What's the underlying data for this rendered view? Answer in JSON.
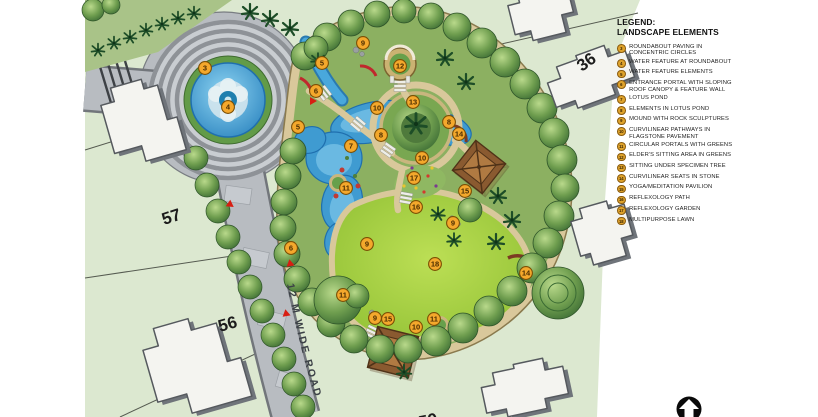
{
  "legend": {
    "title_line1": "LEGEND:",
    "title_line2": "LANDSCAPE ELEMENTS",
    "items": [
      {
        "num": "3",
        "label": "ROUNDABOUT PAVING IN CONCENTRIC CIRCLES"
      },
      {
        "num": "4",
        "label": "WATER FEATURE AT ROUNDABOUT"
      },
      {
        "num": "5",
        "label": "WATER FEATURE ELEMENTS"
      },
      {
        "num": "6",
        "label": "ENTRANCE PORTAL WITH SLOPING ROOF CANOPY & FEATURE WALL"
      },
      {
        "num": "7",
        "label": "LOTUS POND"
      },
      {
        "num": "8",
        "label": "ELEMENTS IN LOTUS POND"
      },
      {
        "num": "9",
        "label": "MOUND WITH ROCK SCULPTURES"
      },
      {
        "num": "10",
        "label": "CURVILINEAR PATHWAYS IN FLAGSTONE PAVEMENT"
      },
      {
        "num": "11",
        "label": "CIRCULAR PORTALS WITH GREENS"
      },
      {
        "num": "12",
        "label": "ELDER'S SITTING AREA IN GREENS"
      },
      {
        "num": "13",
        "label": "SITTING UNDER SPECIMEN TREE"
      },
      {
        "num": "14",
        "label": "CURVILINEAR SEATS IN STONE"
      },
      {
        "num": "15",
        "label": "YOGA/MEDITATION PAVILION"
      },
      {
        "num": "16",
        "label": "REFLEXOLOGY PATH"
      },
      {
        "num": "17",
        "label": "REFLEXOLOGY GARDEN"
      },
      {
        "num": "18",
        "label": "MULTIPURPOSE LAWN"
      }
    ]
  },
  "map": {
    "road_label": "12 M WIDE ROAD",
    "plot_labels": {
      "p36": "36",
      "p57": "57",
      "p56": "56",
      "p59": "59"
    },
    "markers": [
      {
        "num": "3"
      },
      {
        "num": "4"
      },
      {
        "num": "5"
      },
      {
        "num": "6"
      },
      {
        "num": "5"
      },
      {
        "num": "9"
      },
      {
        "num": "12"
      },
      {
        "num": "13"
      },
      {
        "num": "10"
      },
      {
        "num": "8"
      },
      {
        "num": "7"
      },
      {
        "num": "8"
      },
      {
        "num": "14"
      },
      {
        "num": "10"
      },
      {
        "num": "17"
      },
      {
        "num": "11"
      },
      {
        "num": "15"
      },
      {
        "num": "16"
      },
      {
        "num": "9"
      },
      {
        "num": "9"
      },
      {
        "num": "6"
      },
      {
        "num": "18"
      },
      {
        "num": "14"
      },
      {
        "num": "11"
      },
      {
        "num": "9"
      },
      {
        "num": "15"
      },
      {
        "num": "10"
      },
      {
        "num": "11"
      }
    ]
  },
  "colors": {
    "marker_gold": "#f4a82c",
    "water_blue": "#3f9bd1",
    "lawn_green": "#a6d13f",
    "plot_green": "#dce8d0",
    "road_grey": "#b8bcc1",
    "path_tan": "#d9c89b",
    "alert_red": "#d81e12"
  }
}
